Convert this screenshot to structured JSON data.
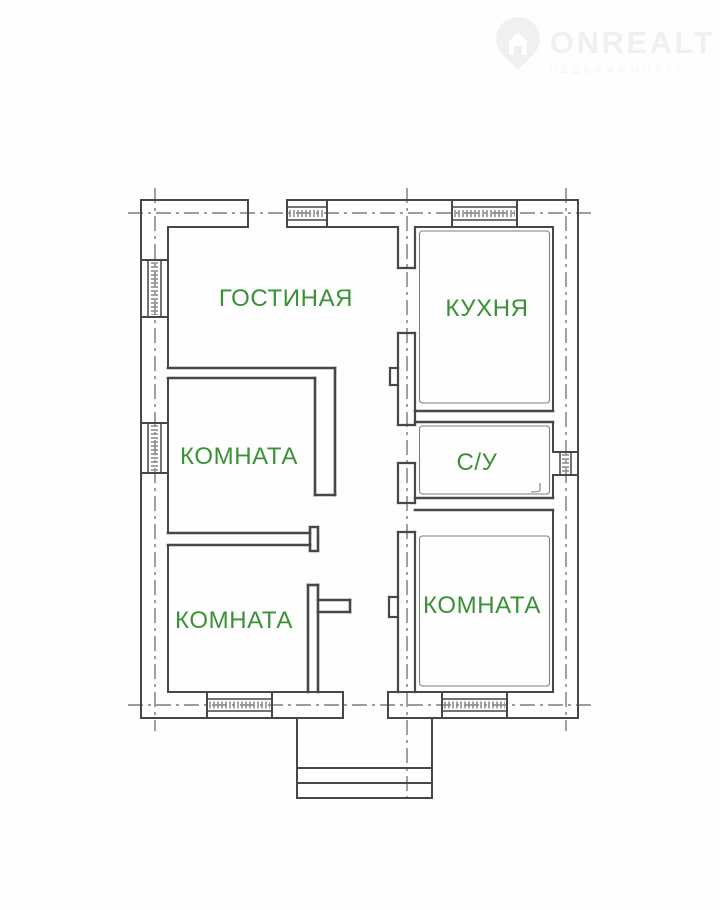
{
  "watermark": {
    "brand": "ONREALT",
    "subtitle": "НЕДВИЖИМОСТЬ",
    "icon": "map-pin-house-icon",
    "color": "#f0f0f0"
  },
  "plan": {
    "label_color": "#3a9136",
    "line_color": "#474747",
    "rooms": [
      {
        "id": "living-room",
        "label": "ГОСТИНАЯ"
      },
      {
        "id": "kitchen",
        "label": "КУХНЯ"
      },
      {
        "id": "room-middle-left",
        "label": "КОМНАТА"
      },
      {
        "id": "bathroom",
        "label": "С/У"
      },
      {
        "id": "room-bottom-left",
        "label": "КОМНАТА"
      },
      {
        "id": "room-bottom-right",
        "label": "КОМНАТА"
      }
    ]
  }
}
